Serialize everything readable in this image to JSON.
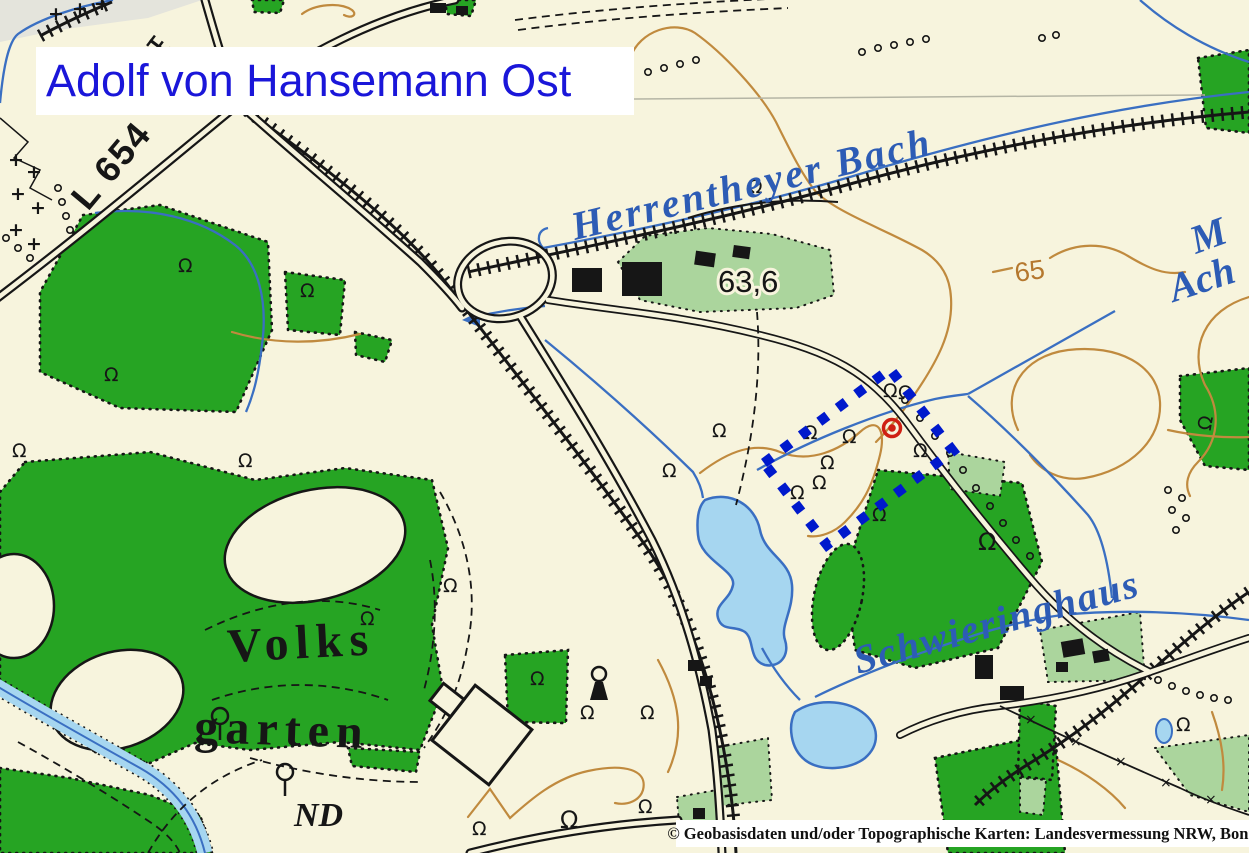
{
  "title": {
    "text": "Adolf von Hansemann Ost"
  },
  "attribution": {
    "text": "© Geobasisdaten und/oder Topographische Karten: Landesvermessung NRW, Bonn"
  },
  "labels": {
    "stream_name": "Herrentheyer Bach",
    "road_number": "L 654",
    "spot_height": "63,6",
    "contour_value": "65",
    "park_name_line1": "Volks",
    "park_name_line2": "garten",
    "nature_monument": "ND",
    "place_name_partial": "Schwieringhaus",
    "edge_label_m": "M",
    "edge_label_ach": "Ach"
  },
  "symbols": {
    "deciduous_tree": "Ω",
    "cross": "+",
    "boundary_mark": "×"
  },
  "selection": {
    "shape": "dotted-rectangle",
    "rect_color": "#0019cc",
    "point_color": "#cf2014"
  },
  "colors": {
    "background": "#f7f4dd",
    "forest_green": "#26a423",
    "light_green": "#abd59d",
    "water_fill": "#a6d6f0",
    "water_line": "#3a6fc2",
    "contour_brown": "#c08a3e",
    "title_blue": "#1a16d9",
    "map_ink": "#161616"
  }
}
